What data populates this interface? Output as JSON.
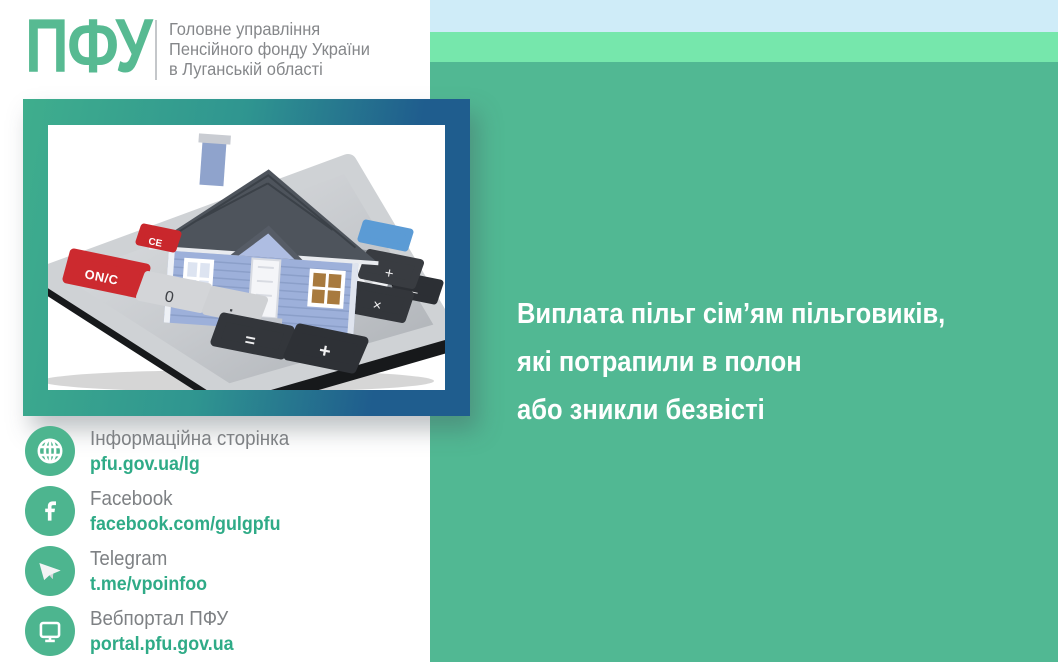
{
  "brand": {
    "logo": "ПФУ",
    "org_lines": [
      "Головне управління",
      "Пенсійного фонду України",
      "в Луганській області"
    ]
  },
  "headline": {
    "lines": [
      "Виплата пільг сім’ям пільговиків,",
      "які потрапили в полон",
      "або зникли безвісті"
    ]
  },
  "contacts": [
    {
      "icon": "globe-icon",
      "label": "Інформаційна сторінка",
      "link": "pfu.gov.ua/lg"
    },
    {
      "icon": "facebook-icon",
      "label": "Facebook",
      "link": "facebook.com/gulgpfu"
    },
    {
      "icon": "telegram-icon",
      "label": "Telegram",
      "link": "t.me/vpoinfoo"
    },
    {
      "icon": "monitor-icon",
      "label": "Вебпортал ПФУ",
      "link": "portal.pfu.gov.ua"
    }
  ],
  "illustration": {
    "subject": "blue house standing on a gray desk calculator",
    "display_ghost": "8.8.8",
    "display_value": "0.",
    "keys": {
      "on_c": "ON/C",
      "ce": "CE",
      "zero": "0",
      "dot": "·",
      "equals": "=",
      "plus_big": "+",
      "plus": "+",
      "multiply": "×",
      "minus": "−"
    }
  },
  "colors": {
    "panel_green": "#51b893",
    "band_light_green": "#76e7ac",
    "band_light_blue": "#cfecf8",
    "logo_green": "#57ba92",
    "link_green": "#2fab87",
    "text_gray": "#85878a",
    "frame_green": "#3fae8d",
    "frame_blue": "#1f5d8e",
    "key_red": "#c9272c",
    "key_blue": "#5b9bd5"
  }
}
